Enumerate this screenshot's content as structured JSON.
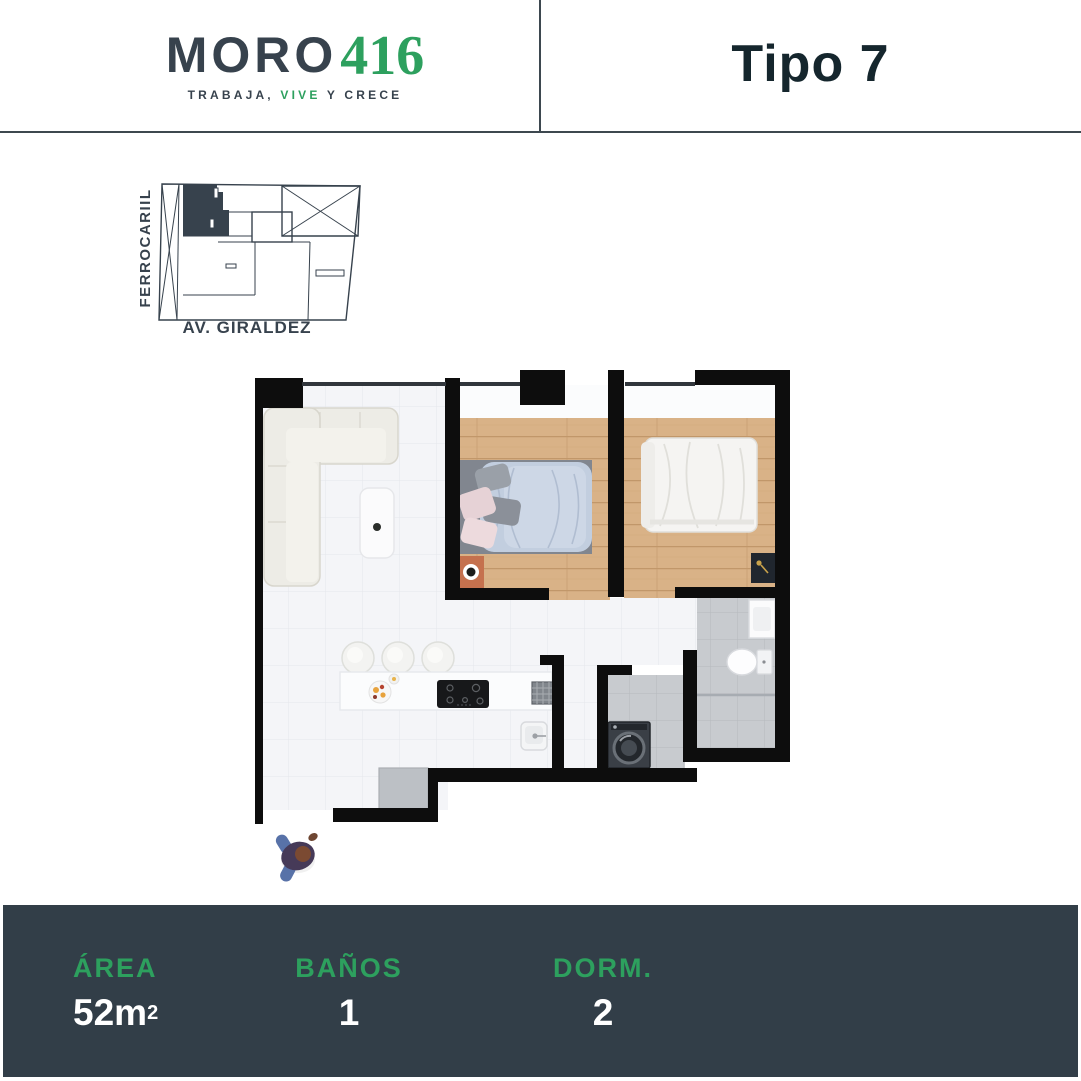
{
  "header": {
    "brand_primary": "MORO",
    "brand_number": "416",
    "tagline_part1": "TRABAJA, ",
    "tagline_part2": "VIVE",
    "tagline_part3": " Y CRECE",
    "unit_title": "Tipo 7"
  },
  "site_plan": {
    "street_left": "FERROCARIIL",
    "street_bottom": "AV. GIRALDEZ"
  },
  "floor_plan": {
    "icons": [
      "l-shaped-sofa",
      "coffee-table",
      "double-bed-blue",
      "double-bed-white",
      "orange-nightstand",
      "dark-nightstand",
      "toilet",
      "bathroom-sink",
      "kitchen-counter",
      "bar-stools",
      "cooktop",
      "dish-rack",
      "kitchen-sink",
      "washing-machine",
      "floor-mat",
      "person-top-view"
    ]
  },
  "footer": {
    "stats": [
      {
        "label": "ÁREA",
        "value": "52m",
        "sup": "2"
      },
      {
        "label": "BAÑOS",
        "value": "1"
      },
      {
        "label": "DORM.",
        "value": "2"
      }
    ]
  },
  "colors": {
    "accent_green": "#2da05e",
    "brand_navy": "#37424d",
    "title_navy": "#15262d",
    "footer_bg": "#323e48",
    "divider": "#3d484f",
    "wall_black": "#0d0d0d",
    "wood": "#d9b287",
    "wood_line": "#c1976a",
    "tile": "#f4f5f8",
    "tile_line": "#e5e7eb",
    "gray_tile": "#c8cbcf",
    "gray_tile_line": "#b6b9bd",
    "sofa": "#edece6",
    "sofa_line": "#d8d6cd",
    "bed_blue": "#c2cedf",
    "bed_platform": "#81868f",
    "nightstand_orange": "#c5714e"
  }
}
